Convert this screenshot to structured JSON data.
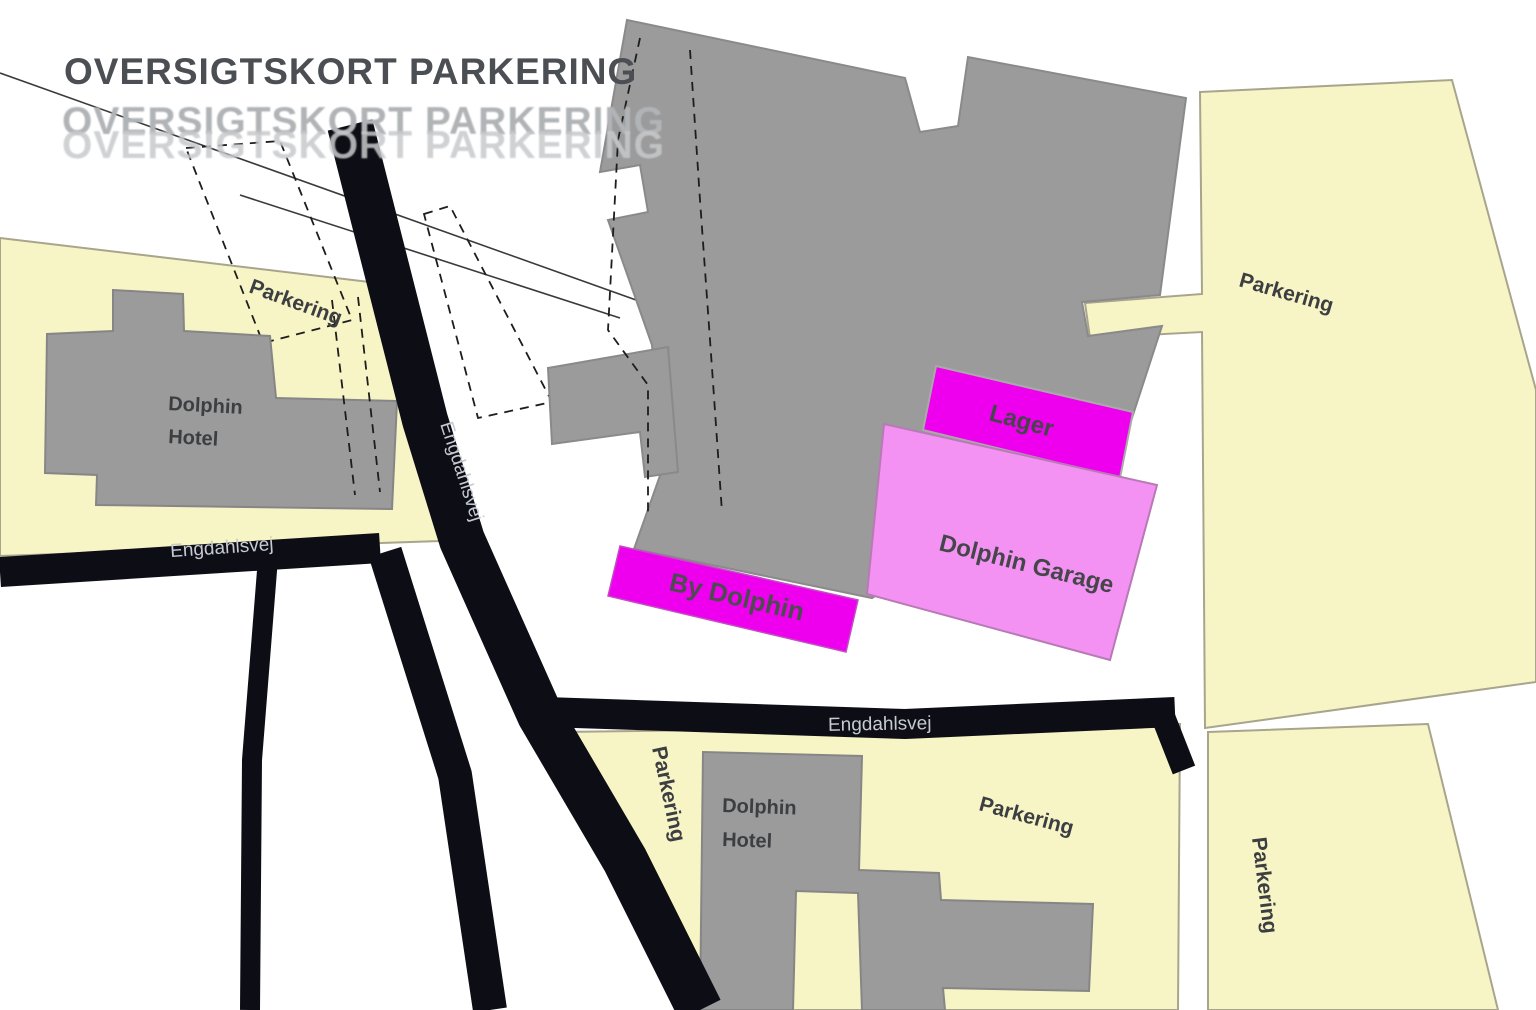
{
  "title": {
    "text": "OVERSIGTSKORT PARKERING"
  },
  "streets": {
    "engdahlsvej": "Engdahlsvej"
  },
  "areas": {
    "parkering": "Parkering",
    "lager": "Lager",
    "garage": "Dolphin Garage",
    "by_dolphin": "By Dolphin"
  },
  "buildings": {
    "dolphin_line1": "Dolphin",
    "dolphin_line2": "Hotel"
  },
  "colors": {
    "parcel": "#f7f4c6",
    "parcel_border": "#a8a58c",
    "building": "#9b9b9b",
    "building_border": "#868686",
    "road": "#0d0e15",
    "magenta": "#ee00ee",
    "pink": "#f392f2",
    "label_dark": "#3c3e41",
    "road_label": "#c6cad2",
    "title_dark": "#4b4f53",
    "title_ghost": "#b1b4b7"
  }
}
